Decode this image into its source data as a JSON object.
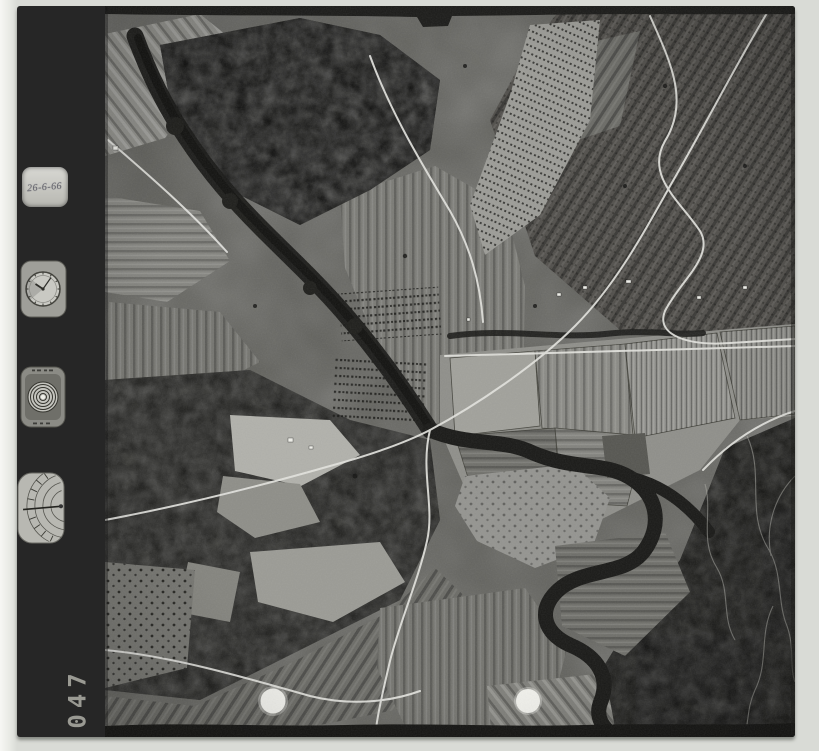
{
  "page": {
    "description": "Scanned black-and-white vertical aerial survey photograph with film data strip",
    "colors": {
      "scan_background": "#d9dbd6",
      "film_strip": "#262626",
      "punch_hole": "#f1f1ec"
    }
  },
  "data_strip": {
    "handwritten_date": "26-6-66",
    "frame_number": "047",
    "instruments": [
      {
        "name": "date-window",
        "value": "26-6-66"
      },
      {
        "name": "clock-dial"
      },
      {
        "name": "bubble-level-dial"
      },
      {
        "name": "altimeter-dial"
      }
    ]
  },
  "photo": {
    "punch_holes": 2,
    "content": "farmland with strip fields, orchard rows, tree-lined winding river, white roads, woodland and dark scrub hills"
  }
}
